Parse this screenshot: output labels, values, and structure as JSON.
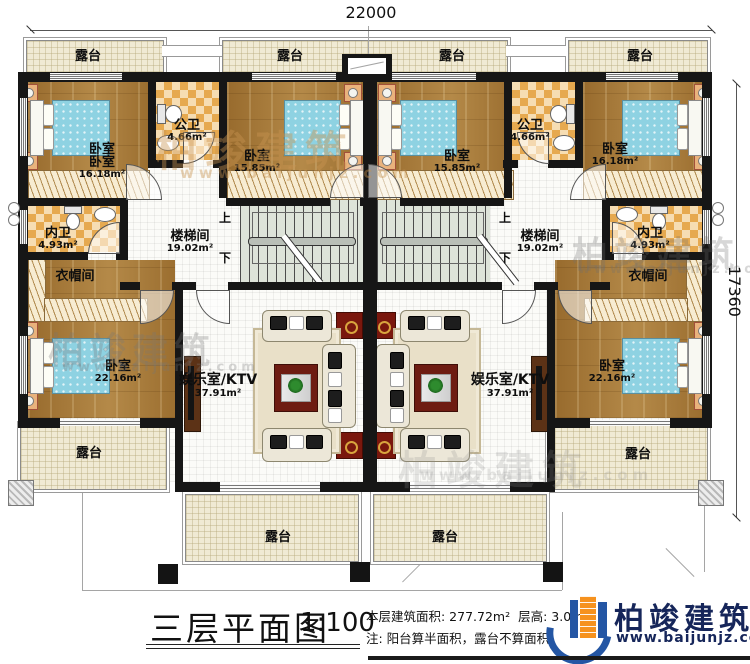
{
  "drawing": {
    "title": "三层平面图",
    "scale": "1:100",
    "area_note": "本层建筑面积: 277.72m²",
    "height_note": "层高: 3.0m",
    "remark": "注: 阳台算半面积，露台不算面积",
    "dim_top": "22000",
    "dim_right": "17360"
  },
  "brand": {
    "name": "柏竣建筑",
    "site": "www.baijunjz.com"
  },
  "labels": {
    "terrace": "露台",
    "bedroom": "卧室",
    "public_bath": "公卫",
    "inner_bath": "内卫",
    "cloakroom": "衣帽间",
    "stairwell": "楼梯间",
    "ktv": "娱乐室/KTV",
    "up": "上",
    "down": "下"
  },
  "areas": {
    "bedroom_outer": "16.18m²",
    "bedroom_center": "15.85m²",
    "public_bath": "4.66m²",
    "inner_bath": "4.93m²",
    "stairwell": "19.02m²",
    "bedroom_lower": "22.16m²",
    "ktv": "37.91m²"
  }
}
